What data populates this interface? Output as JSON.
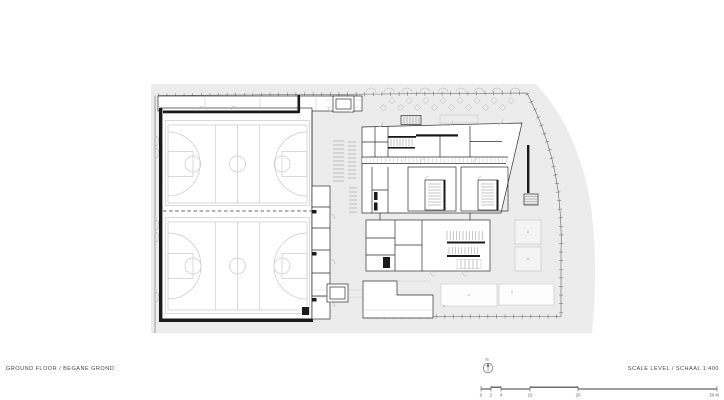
{
  "footer": {
    "left_label": "GROUND FLOOR / BEGANE GROND",
    "right_label": "SCALE LEVEL / SCHAAL 1:400"
  },
  "north_indicator": {
    "label": "N"
  },
  "scale_bar": {
    "labels": [
      "0",
      "2",
      "4",
      "10",
      "20",
      "50 M"
    ]
  },
  "colors": {
    "site_fill": "#ececec",
    "wall": "#1a1a1a",
    "line": "#2e2e2e",
    "court_line": "#c9c9c9",
    "text_gray": "#4a4a4a"
  }
}
